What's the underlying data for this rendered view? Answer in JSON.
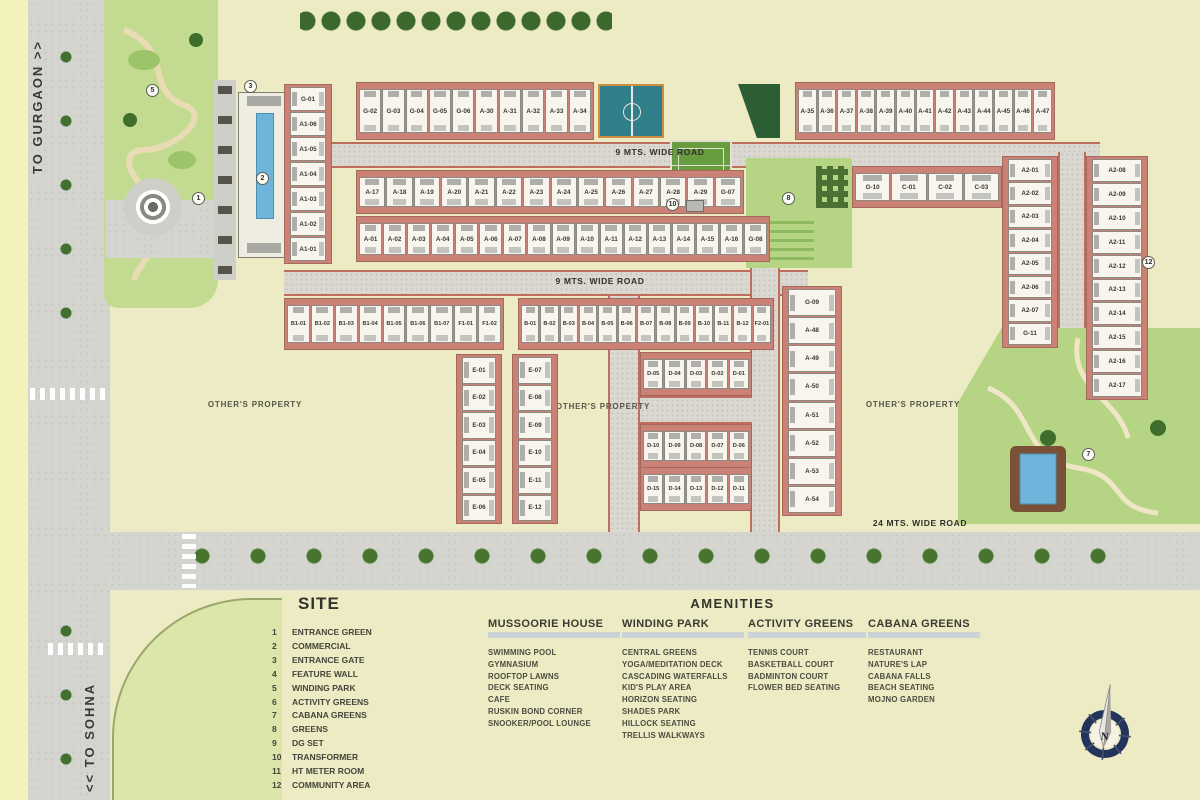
{
  "roads": {
    "to_gurgaon": "TO GURGAON >>",
    "to_sohna": "<< TO SOHNA",
    "road9": "9 MTS. WIDE ROAD",
    "road24": "24 MTS. WIDE ROAD"
  },
  "map": {
    "others_property": "OTHER'S PROPERTY",
    "compass_n": "N",
    "markers": {
      "m1": "1",
      "m2": "2",
      "m3": "3",
      "m5": "5",
      "m7": "7",
      "m8": "8",
      "m10": "10",
      "m12": "12"
    },
    "plots": {
      "row_top_left": [
        "G-02",
        "G-03",
        "G-04",
        "G-05",
        "G-06",
        "A-30",
        "A-31",
        "A-32",
        "A-33",
        "A-34"
      ],
      "row_top_right": [
        "A-35",
        "A-36",
        "A-37",
        "A-38",
        "A-39",
        "A-40",
        "A-41",
        "A-42",
        "A-43",
        "A-44",
        "A-45",
        "A-46",
        "A-47"
      ],
      "row2": [
        "A-17",
        "A-18",
        "A-19",
        "A-20",
        "A-21",
        "A-22",
        "A-23",
        "A-24",
        "A-25",
        "A-26",
        "A-27",
        "A-28",
        "A-29",
        "G-07"
      ],
      "row3": [
        "A-01",
        "A-02",
        "A-03",
        "A-04",
        "A-05",
        "A-06",
        "A-07",
        "A-08",
        "A-09",
        "A-10",
        "A-11",
        "A-12",
        "A-13",
        "A-14",
        "A-15",
        "A-16",
        "G-08"
      ],
      "col_a1": [
        "G-01",
        "A1-06",
        "A1-05",
        "A1-04",
        "A1-03",
        "A1-02",
        "A1-01"
      ],
      "row_c": [
        "G-10",
        "C-01",
        "C-02",
        "C-03"
      ],
      "row_b1": [
        "B1-01",
        "B1-02",
        "B1-03",
        "B1-04",
        "B1-05",
        "B1-06",
        "B1-07",
        "F1-01",
        "F1-02"
      ],
      "row_b": [
        "B-01",
        "B-02",
        "B-03",
        "B-04",
        "B-05",
        "B-06",
        "B-07",
        "B-08",
        "B-09",
        "B-10",
        "B-11",
        "B-12",
        "F2-01"
      ],
      "col_e_left": [
        "E-01",
        "E-02",
        "E-03",
        "E-04",
        "E-05",
        "E-06"
      ],
      "col_e_right": [
        "E-07",
        "E-08",
        "E-09",
        "E-10",
        "E-11",
        "E-12"
      ],
      "d_row1": [
        "D-05",
        "D-04",
        "D-03",
        "D-02",
        "D-01"
      ],
      "d_row2": [
        "D-10",
        "D-09",
        "D-08",
        "D-07",
        "D-06"
      ],
      "d_row3": [
        "D-15",
        "D-14",
        "D-13",
        "D-12",
        "D-11"
      ],
      "col_a48": [
        "G-09",
        "A-48",
        "A-49",
        "A-50",
        "A-51",
        "A-52",
        "A-53",
        "A-54"
      ],
      "col_a2_left": [
        "A2-01",
        "A2-02",
        "A2-03",
        "A2-04",
        "A2-05",
        "A2-06",
        "A2-07",
        "G-11"
      ],
      "col_a2_right": [
        "A2-08",
        "A2-09",
        "A2-10",
        "A2-11",
        "A2-12",
        "A2-13",
        "A2-14",
        "A2-15",
        "A2-16",
        "A2-17"
      ]
    }
  },
  "legend": {
    "site": {
      "title": "SITE",
      "items": [
        {
          "num": "1",
          "label": "ENTRANCE GREEN"
        },
        {
          "num": "2",
          "label": "COMMERCIAL"
        },
        {
          "num": "3",
          "label": "ENTRANCE GATE"
        },
        {
          "num": "4",
          "label": "FEATURE WALL"
        },
        {
          "num": "5",
          "label": "WINDING PARK"
        },
        {
          "num": "6",
          "label": "ACTIVITY GREENS"
        },
        {
          "num": "7",
          "label": "CABANA GREENS"
        },
        {
          "num": "8",
          "label": "GREENS"
        },
        {
          "num": "9",
          "label": "DG SET"
        },
        {
          "num": "10",
          "label": "TRANSFORMER"
        },
        {
          "num": "11",
          "label": "HT METER ROOM"
        },
        {
          "num": "12",
          "label": "COMMUNITY AREA"
        }
      ]
    },
    "amenities": {
      "title": "AMENITIES",
      "columns": [
        {
          "title": "MUSSOORIE HOUSE",
          "items": [
            "SWIMMING POOL",
            "GYMNASIUM",
            "ROOFTOP LAWNS",
            "DECK SEATING",
            "CAFE",
            "RUSKIN BOND CORNER",
            "SNOOKER/POOL LOUNGE"
          ]
        },
        {
          "title": "WINDING PARK",
          "items": [
            "CENTRAL GREENS",
            "YOGA/MEDITATION DECK",
            "CASCADING WATERFALLS",
            "KID'S PLAY AREA",
            "HORIZON SEATING",
            "SHADES PARK",
            "HILLOCK SEATING",
            "TRELLIS WALKWAYS"
          ]
        },
        {
          "title": "ACTIVITY GREENS",
          "items": [
            "TENNIS COURT",
            "BASKETBALL COURT",
            "BADMINTON COURT",
            "FLOWER BED SEATING"
          ]
        },
        {
          "title": "CABANA GREENS",
          "items": [
            "RESTAURANT",
            "NATURE'S LAP",
            "CABANA FALLS",
            "BEACH SEATING",
            "MOJNO GARDEN"
          ]
        }
      ]
    }
  },
  "colors": {
    "background": "#ecebc4",
    "road": "#d5d5d0",
    "block_backing": "#cb8175",
    "green": "#b5d584",
    "pool_blue": "#6db5da",
    "compass_navy": "#22335c"
  }
}
